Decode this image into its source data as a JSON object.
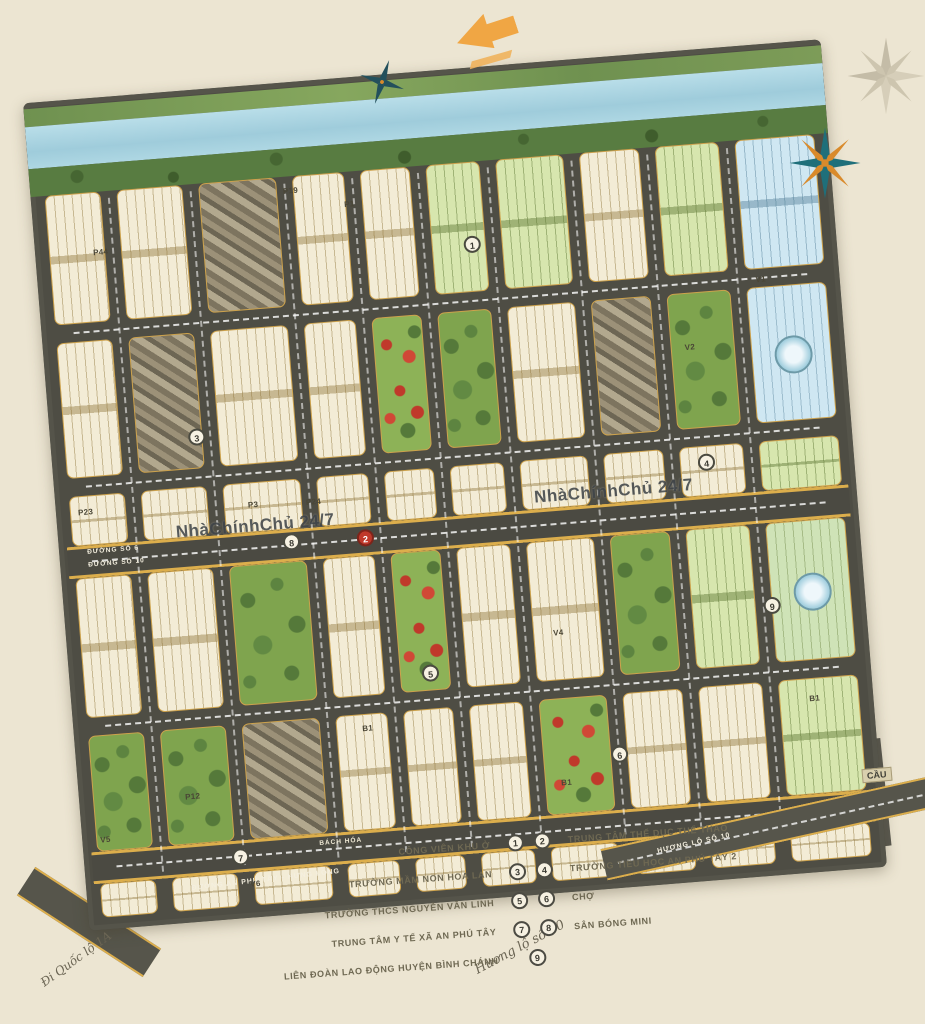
{
  "watermark": {
    "text": "NhàChínhChủ 24/7"
  },
  "map": {
    "bridge_label": "CẦU",
    "road_labels": {
      "duong_so_6": "ĐƯỜNG SỐ 6",
      "duong_so_10": "ĐƯỜNG SỐ 10",
      "an_phu_tay_hung_long": "ĐƯỜNG AN PHÚ TÂY - HƯNG LONG",
      "huong_lo_10": "HƯƠNG LỘ SỐ 10",
      "huong_lo_10_hand": "Hương lộ số 10",
      "di_quoc_lo_1a": "Đi Quốc lộ 1A",
      "bach_hoa": "BÁCH HÓA"
    },
    "block_labels": [
      "P44",
      "P19",
      "P1",
      "P23",
      "P3",
      "P24",
      "V1",
      "V2",
      "P12",
      "V5",
      "V6",
      "B1",
      "B1",
      "B1",
      "V4"
    ],
    "markers": [
      "1",
      "2",
      "3",
      "4",
      "5",
      "6",
      "7",
      "8",
      "9"
    ]
  },
  "legend": {
    "rows": [
      {
        "left_num": "1",
        "left": "CÔNG VIÊN KHU Ở",
        "right_num": "2",
        "right": "TRUNG TÂM THỂ DỤC THỂ THAO"
      },
      {
        "left_num": "3",
        "left": "TRƯỜNG MẦM NON HOA LAN",
        "right_num": "4",
        "right": "TRƯỜNG TIỂU HỌC AN PHÚ TÂY 2"
      },
      {
        "left_num": "5",
        "left": "TRƯỜNG THCS NGUYỄN VĂN LINH",
        "right_num": "6",
        "right": "CHỢ"
      },
      {
        "left_num": "7",
        "left": "TRUNG TÂM Y TẾ XÃ AN PHÚ TÂY",
        "right_num": "8",
        "right": "SÂN BÓNG MINI"
      },
      {
        "left_num": "9",
        "left": "LIÊN ĐOÀN LAO ĐỘNG HUYỆN BÌNH CHÁNH",
        "right_num": "",
        "right": ""
      }
    ]
  },
  "colors": {
    "background": "#ece5d2",
    "road": "#4b4a42",
    "plot_cream": "#f3ecd6",
    "plot_green": "#d7e6ae",
    "plot_blue": "#cfe7f2",
    "park": "#7fa44e",
    "water": "#a9d4e4",
    "accent_yellow": "#dcae4c",
    "flower_red": "#c0392b"
  }
}
